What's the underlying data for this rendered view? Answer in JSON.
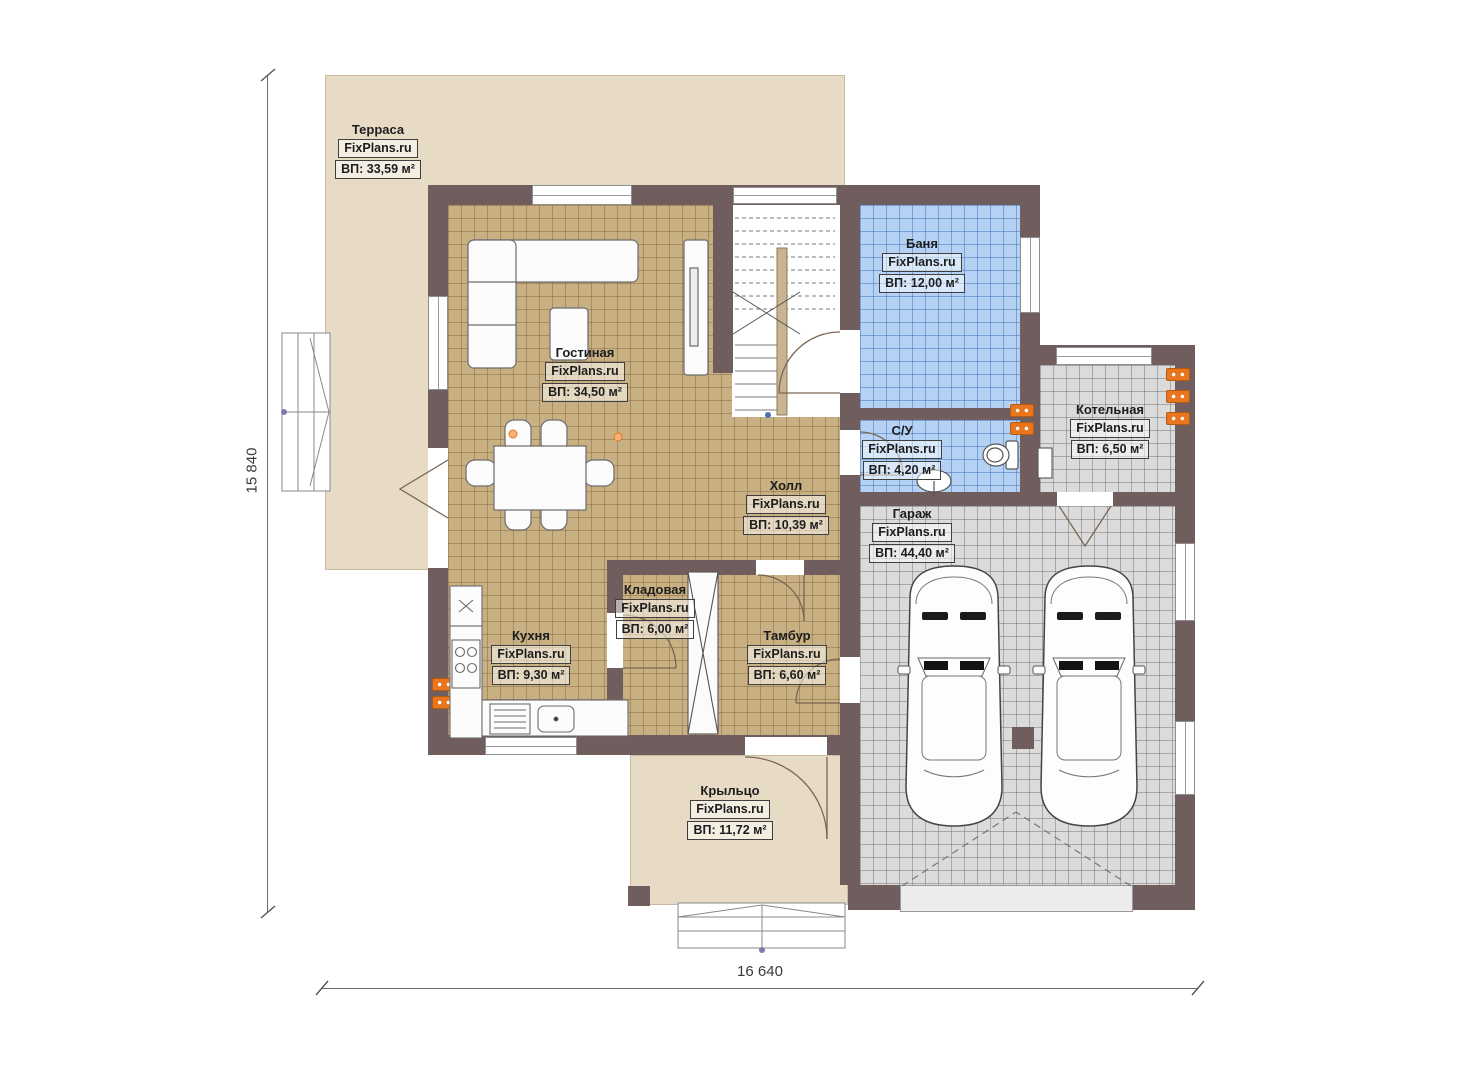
{
  "site_label": "FixPlans.ru",
  "dims": {
    "horizontal": "16 640",
    "vertical": "15 840"
  },
  "rooms": [
    {
      "id": "terrace",
      "name": "Терраса",
      "area": "ВП: 33,59 м²"
    },
    {
      "id": "living",
      "name": "Гостиная",
      "area": "ВП: 34,50 м²"
    },
    {
      "id": "sauna",
      "name": "Баня",
      "area": "ВП: 12,00 м²"
    },
    {
      "id": "wc",
      "name": "С/У",
      "area": "ВП: 4,20 м²"
    },
    {
      "id": "boiler",
      "name": "Котельная",
      "area": "ВП: 6,50 м²"
    },
    {
      "id": "hall",
      "name": "Холл",
      "area": "ВП: 10,39 м²"
    },
    {
      "id": "garage",
      "name": "Гараж",
      "area": "ВП: 44,40 м²"
    },
    {
      "id": "storage",
      "name": "Кладовая",
      "area": "ВП: 6,00 м²"
    },
    {
      "id": "vestibule",
      "name": "Тамбур",
      "area": "ВП: 6,60 м²"
    },
    {
      "id": "kitchen",
      "name": "Кухня",
      "area": "ВП: 9,30 м²"
    },
    {
      "id": "porch",
      "name": "Крыльцо",
      "area": "ВП: 11,72 м²"
    }
  ],
  "colors": {
    "wall": "#705d5d",
    "wood_floor": "#c8b083",
    "tile_blue": "#b5d2f4",
    "tile_gray": "#dbdbdb",
    "terrace": "#e8dbc5",
    "radiator": "#e8761e"
  }
}
